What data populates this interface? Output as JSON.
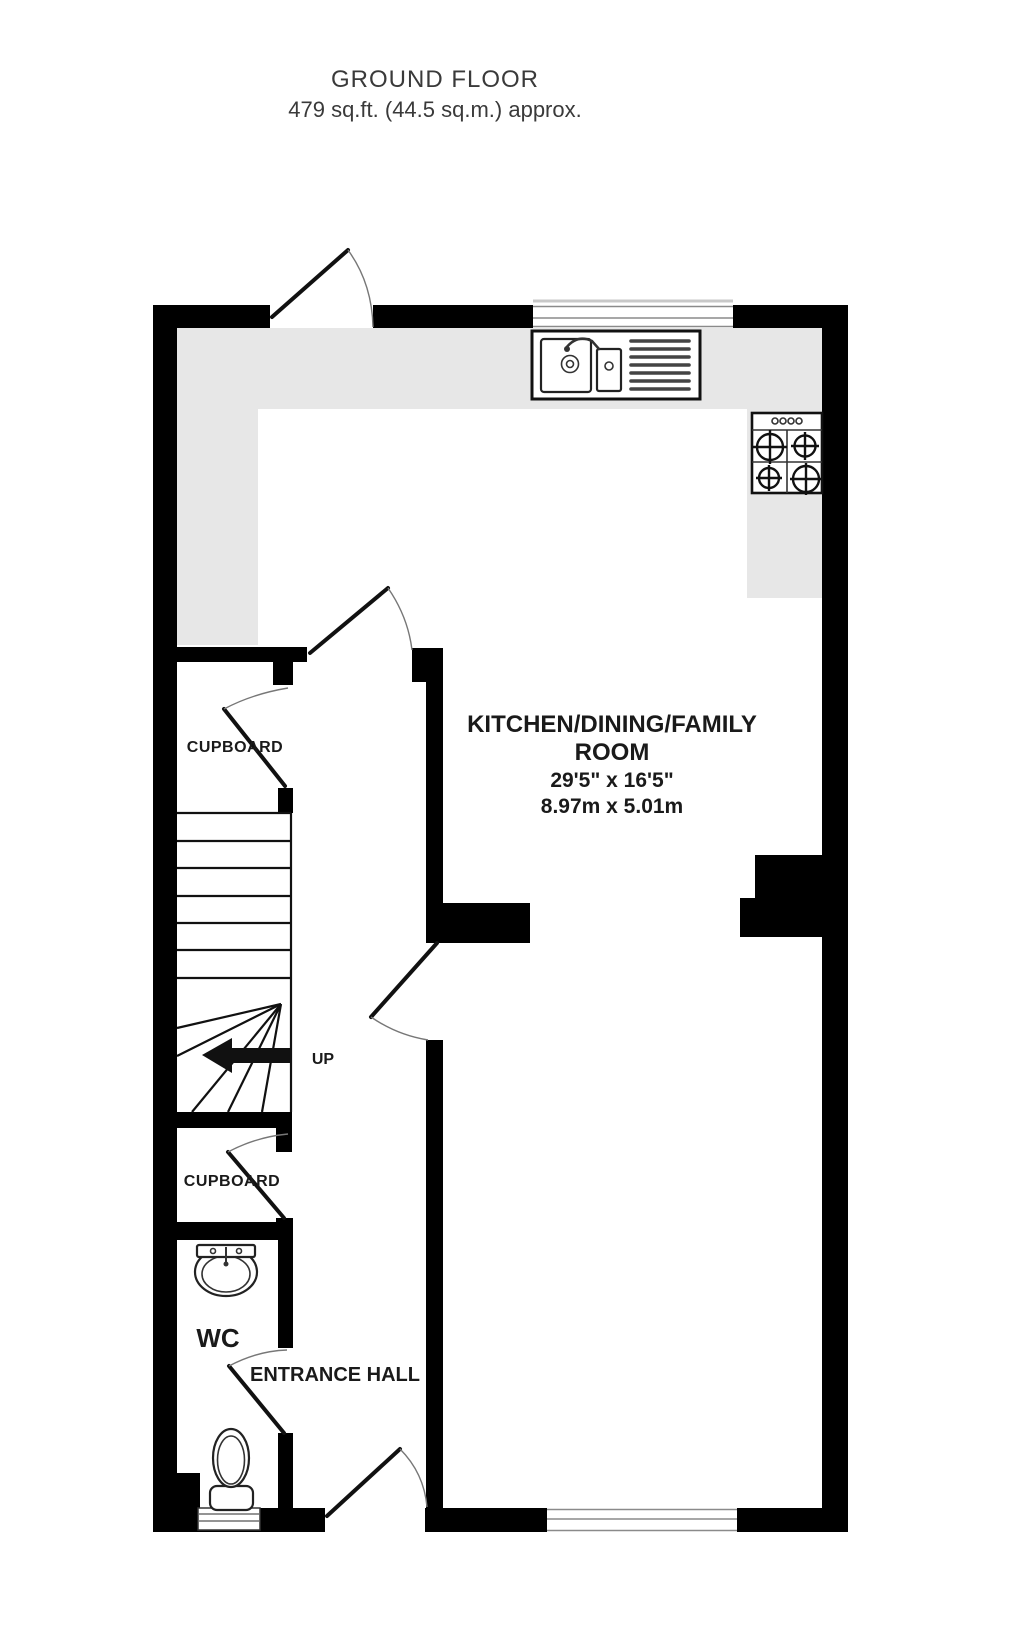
{
  "title": {
    "line1": "GROUND FLOOR",
    "line2": "479 sq.ft. (44.5 sq.m.) approx."
  },
  "floorplan": {
    "kitchen": {
      "name_line1": "KITCHEN/DINING/FAMILY",
      "name_line2": "ROOM",
      "dims_imperial": "29'5\" x 16'5\"",
      "dims_metric": "8.97m x 5.01m"
    },
    "cupboard_top": {
      "label": "CUPBOARD"
    },
    "cupboard_bottom": {
      "label": "CUPBOARD"
    },
    "wc": {
      "label": "WC"
    },
    "entrance_hall": {
      "label": "ENTRANCE HALL"
    },
    "stairs": {
      "direction_label": "UP"
    },
    "colors": {
      "wall": "#000000",
      "counter": "#e7e7e7",
      "background": "#ffffff",
      "label_text": "#1a1a1a"
    }
  }
}
